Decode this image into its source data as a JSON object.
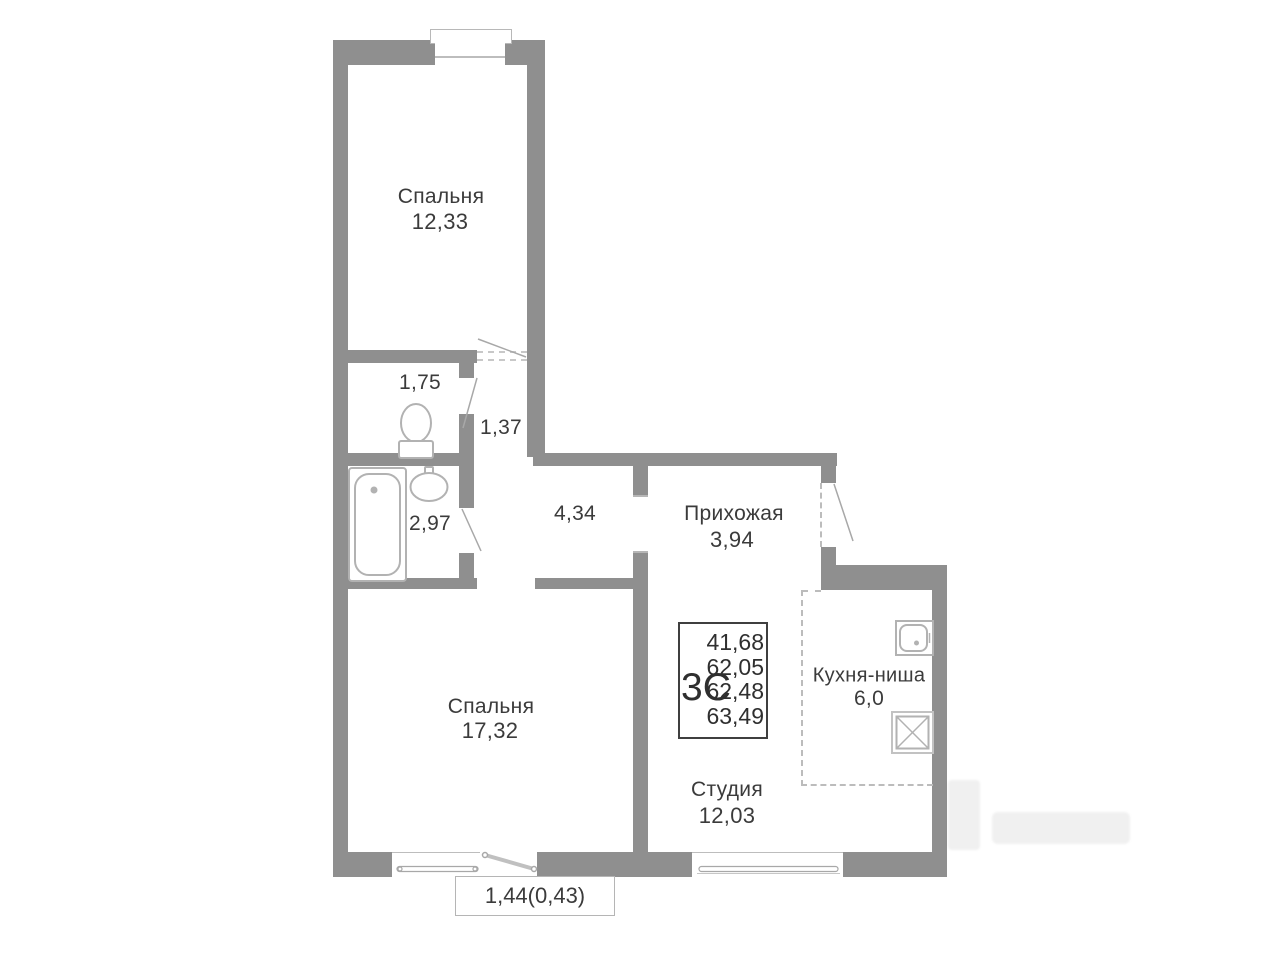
{
  "plan": {
    "type_label": "3С",
    "area_values": [
      "41,68",
      "62,05",
      "62,48",
      "63,49"
    ],
    "balcony_label": "1,44(0,43)",
    "rooms": {
      "bedroom_top": {
        "name": "Спальня",
        "area": "12,33"
      },
      "wc": {
        "area": "1,75"
      },
      "corridor": {
        "area": "1,37"
      },
      "bathroom": {
        "area": "2,97"
      },
      "hall": {
        "area": "4,34"
      },
      "entry": {
        "name": "Прихожая",
        "area": "3,94"
      },
      "bedroom_bottom": {
        "name": "Спальня",
        "area": "17,32"
      },
      "kitchen": {
        "name": "Кухня-ниша",
        "area": "6,0"
      },
      "studio": {
        "name": "Студия",
        "area": "12,03"
      }
    },
    "colors": {
      "wall": "#8f8f8f",
      "fixture_line": "#b2b2b2",
      "text": "#3b3b3b"
    },
    "icons": [
      "toilet-icon",
      "bathtub-icon",
      "sink-icon",
      "kitchen-sink-icon",
      "stove-icon"
    ]
  }
}
